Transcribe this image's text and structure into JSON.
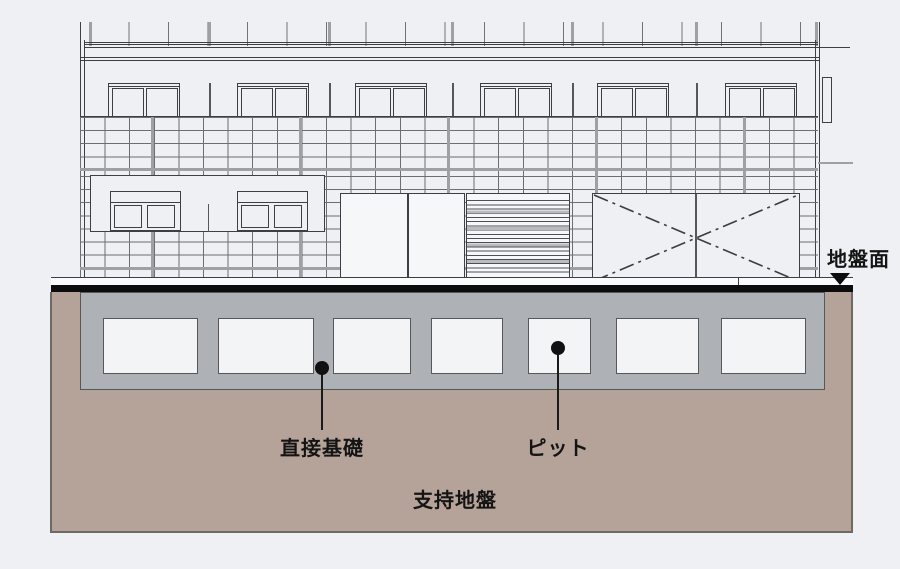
{
  "diagram": {
    "labels": {
      "ground_surface": "地盤面",
      "direct_foundation": "直接基礎",
      "pit": "ピット",
      "bearing_stratum": "支持地盤"
    },
    "icons": {
      "ground_level_marker": "down-triangle"
    },
    "colors": {
      "background": "#eef0f3",
      "line_dark": "#3c3f43",
      "tile_line": "#6b6e72",
      "joint_gray": "#9da0a5",
      "soil": "#b5a298",
      "soil_border": "#6e6965",
      "structure_gray": "#aeb1b5",
      "structure_outline": "#54575b",
      "ground_line": "#0d0d0d",
      "pit_fill": "#f3f4f6",
      "white_panel": "#f6f7f9",
      "label": "#141414"
    }
  }
}
